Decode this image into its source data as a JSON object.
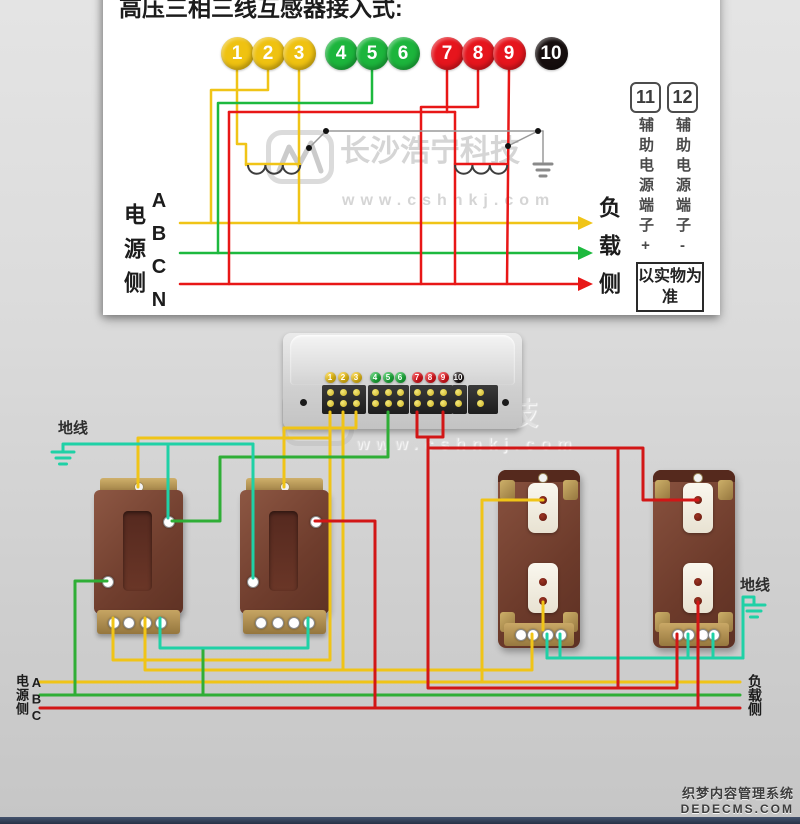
{
  "title": "高压三相三线互感器接入式:",
  "watermark": {
    "name": "长沙浩宁科技",
    "url": "www.cshnkj.com"
  },
  "cms_watermark": {
    "line1": "织梦内容管理系统",
    "line2": "DEDECMS.COM"
  },
  "top_panel": {
    "source_side": "电源侧",
    "phases": "ABCN",
    "load_side": "负载侧",
    "note": "以实物为准",
    "aux": [
      {
        "id": "11",
        "label": "辅助电源端子+"
      },
      {
        "id": "12",
        "label": "辅助电源端子-"
      }
    ],
    "terminals": [
      {
        "n": "1",
        "color": "#efc211",
        "x": 237
      },
      {
        "n": "2",
        "color": "#efc211",
        "x": 268
      },
      {
        "n": "3",
        "color": "#efc211",
        "x": 299
      },
      {
        "n": "4",
        "color": "#1cb53c",
        "x": 341
      },
      {
        "n": "5",
        "color": "#1cb53c",
        "x": 372
      },
      {
        "n": "6",
        "color": "#1cb53c",
        "x": 403
      },
      {
        "n": "7",
        "color": "#e6151d",
        "x": 447
      },
      {
        "n": "8",
        "color": "#e6151d",
        "x": 478
      },
      {
        "n": "9",
        "color": "#e6151d",
        "x": 509
      },
      {
        "n": "10",
        "color": "#160e0e",
        "x": 551
      }
    ]
  },
  "meter": {
    "terminals": [
      {
        "n": "1",
        "color": "#efc211",
        "x": 330
      },
      {
        "n": "2",
        "color": "#efc211",
        "x": 343
      },
      {
        "n": "3",
        "color": "#efc211",
        "x": 356
      },
      {
        "n": "4",
        "color": "#1cb53c",
        "x": 375
      },
      {
        "n": "5",
        "color": "#1cb53c",
        "x": 388
      },
      {
        "n": "6",
        "color": "#1cb53c",
        "x": 400
      },
      {
        "n": "7",
        "color": "#e6151d",
        "x": 417
      },
      {
        "n": "8",
        "color": "#e6151d",
        "x": 430
      },
      {
        "n": "9",
        "color": "#e6151d",
        "x": 443
      },
      {
        "n": "10",
        "color": "#160e0e",
        "x": 458
      }
    ],
    "screw_columns": [
      330,
      343,
      356,
      375,
      388,
      400,
      417,
      430,
      443,
      458,
      480
    ]
  },
  "bottom": {
    "ground_left": "地线",
    "ground_right": "地线",
    "source_side": "电源侧",
    "source_phases": "ABC",
    "load_side": "负载侧"
  },
  "wiring": {
    "wires": [
      {
        "c": "#f0c417",
        "w": 2.5,
        "p": [
          [
            180,
            223
          ],
          [
            578,
            223
          ]
        ]
      },
      {
        "c": "#f0c417",
        "w": 2.5,
        "p": [
          [
            268,
            70
          ],
          [
            268,
            90
          ],
          [
            211,
            90
          ],
          [
            211,
            223
          ]
        ]
      },
      {
        "c": "#f0c417",
        "w": 2.5,
        "p": [
          [
            237,
            70
          ],
          [
            237,
            144
          ],
          [
            246,
            144
          ],
          [
            246,
            165
          ]
        ]
      },
      {
        "c": "#f0c417",
        "w": 2.5,
        "p": [
          [
            299,
            70
          ],
          [
            299,
            223
          ]
        ]
      },
      {
        "c": "#f0c417",
        "w": 2.5,
        "p": [
          [
            246,
            164
          ],
          [
            300,
            164
          ]
        ]
      },
      {
        "c": "#1db93e",
        "w": 2.5,
        "p": [
          [
            180,
            253
          ],
          [
            578,
            253
          ]
        ]
      },
      {
        "c": "#1db93e",
        "w": 2.5,
        "p": [
          [
            372,
            70
          ],
          [
            372,
            103
          ],
          [
            218,
            103
          ],
          [
            218,
            253
          ]
        ]
      },
      {
        "c": "#e81717",
        "w": 2.5,
        "p": [
          [
            180,
            284
          ],
          [
            578,
            284
          ]
        ]
      },
      {
        "c": "#e81717",
        "w": 2.5,
        "p": [
          [
            447,
            70
          ],
          [
            447,
            112
          ]
        ]
      },
      {
        "c": "#e81717",
        "w": 2.5,
        "p": [
          [
            229,
            112
          ],
          [
            455,
            112
          ]
        ]
      },
      {
        "c": "#e81717",
        "w": 2.5,
        "p": [
          [
            229,
            112
          ],
          [
            229,
            284
          ]
        ]
      },
      {
        "c": "#e81717",
        "w": 2.5,
        "p": [
          [
            455,
            112
          ],
          [
            455,
            284
          ]
        ]
      },
      {
        "c": "#e81717",
        "w": 2.5,
        "p": [
          [
            509,
            70
          ],
          [
            507,
            284
          ]
        ]
      },
      {
        "c": "#e81717",
        "w": 2.5,
        "p": [
          [
            478,
            70
          ],
          [
            478,
            107
          ],
          [
            421,
            107
          ],
          [
            421,
            284
          ]
        ]
      },
      {
        "c": "#e81717",
        "w": 2.5,
        "p": [
          [
            455,
            164
          ],
          [
            507,
            164
          ]
        ]
      },
      {
        "c": "#9a9a9a",
        "w": 1.5,
        "p": [
          [
            309,
            148
          ],
          [
            326,
            131
          ]
        ]
      },
      {
        "c": "#9a9a9a",
        "w": 1.5,
        "p": [
          [
            326,
            131
          ],
          [
            543,
            131
          ]
        ]
      },
      {
        "c": "#9a9a9a",
        "w": 1.5,
        "p": [
          [
            508,
            146
          ],
          [
            538,
            131
          ]
        ]
      },
      {
        "c": "#9a9a9a",
        "w": 1.5,
        "p": [
          [
            543,
            131
          ],
          [
            543,
            162
          ]
        ]
      },
      {
        "c": "#f0c417",
        "w": 3,
        "p": [
          [
            330,
            412
          ],
          [
            330,
            660
          ],
          [
            113,
            660
          ],
          [
            113,
            618
          ]
        ]
      },
      {
        "c": "#f0c417",
        "w": 3,
        "p": [
          [
            343,
            412
          ],
          [
            343,
            670
          ]
        ]
      },
      {
        "c": "#f0c417",
        "w": 3,
        "p": [
          [
            145,
            618
          ],
          [
            145,
            670
          ],
          [
            532,
            670
          ],
          [
            532,
            634
          ]
        ]
      },
      {
        "c": "#f0c417",
        "w": 3,
        "p": [
          [
            543,
            500
          ],
          [
            482,
            500
          ],
          [
            482,
            682
          ]
        ]
      },
      {
        "c": "#f0c417",
        "w": 3,
        "p": [
          [
            543,
            602
          ],
          [
            543,
            630
          ]
        ]
      },
      {
        "c": "#f0c417",
        "w": 3,
        "p": [
          [
            40,
            682
          ],
          [
            740,
            682
          ]
        ]
      },
      {
        "c": "#f0c417",
        "w": 3,
        "p": [
          [
            138,
            487
          ],
          [
            138,
            438
          ],
          [
            330,
            438
          ]
        ]
      },
      {
        "c": "#f0c417",
        "w": 3,
        "p": [
          [
            284,
            487
          ],
          [
            284,
            428
          ],
          [
            356,
            428
          ],
          [
            356,
            412
          ]
        ]
      },
      {
        "c": "#2fae36",
        "w": 3,
        "p": [
          [
            388,
            412
          ],
          [
            388,
            457
          ],
          [
            220,
            457
          ],
          [
            220,
            521
          ],
          [
            172,
            521
          ]
        ]
      },
      {
        "c": "#2fae36",
        "w": 3,
        "p": [
          [
            107,
            581
          ],
          [
            75,
            581
          ],
          [
            75,
            695
          ]
        ]
      },
      {
        "c": "#2fae36",
        "w": 3,
        "p": [
          [
            203,
            648
          ],
          [
            203,
            695
          ]
        ]
      },
      {
        "c": "#2fae36",
        "w": 3,
        "p": [
          [
            40,
            695
          ],
          [
            740,
            695
          ]
        ]
      },
      {
        "c": "#1fd1a6",
        "w": 3,
        "p": [
          [
            63,
            444
          ],
          [
            253,
            444
          ]
        ]
      },
      {
        "c": "#1fd1a6",
        "w": 3,
        "p": [
          [
            168,
            444
          ],
          [
            168,
            518
          ]
        ]
      },
      {
        "c": "#1fd1a6",
        "w": 3,
        "p": [
          [
            253,
            444
          ],
          [
            253,
            578
          ]
        ]
      },
      {
        "c": "#1fd1a6",
        "w": 3,
        "p": [
          [
            160,
            618
          ],
          [
            160,
            648
          ],
          [
            308,
            648
          ],
          [
            308,
            618
          ]
        ]
      },
      {
        "c": "#1fd1a6",
        "w": 3,
        "p": [
          [
            547,
            634
          ],
          [
            547,
            658
          ]
        ]
      },
      {
        "c": "#1fd1a6",
        "w": 3,
        "p": [
          [
            560,
            634
          ],
          [
            560,
            658
          ]
        ]
      },
      {
        "c": "#1fd1a6",
        "w": 3,
        "p": [
          [
            547,
            658
          ],
          [
            743,
            658
          ]
        ]
      },
      {
        "c": "#1fd1a6",
        "w": 3,
        "p": [
          [
            688,
            634
          ],
          [
            688,
            658
          ]
        ]
      },
      {
        "c": "#1fd1a6",
        "w": 3,
        "p": [
          [
            713,
            634
          ],
          [
            713,
            658
          ]
        ]
      },
      {
        "c": "#1fd1a6",
        "w": 3,
        "p": [
          [
            743,
            658
          ],
          [
            743,
            597
          ],
          [
            754,
            597
          ]
        ]
      },
      {
        "c": "#d21616",
        "w": 3,
        "p": [
          [
            417,
            412
          ],
          [
            417,
            437
          ],
          [
            443,
            437
          ],
          [
            443,
            412
          ]
        ]
      },
      {
        "c": "#d21616",
        "w": 3,
        "p": [
          [
            428,
            437
          ],
          [
            428,
            688
          ],
          [
            677,
            688
          ],
          [
            677,
            634
          ]
        ]
      },
      {
        "c": "#d21616",
        "w": 3,
        "p": [
          [
            428,
            448
          ],
          [
            643,
            448
          ],
          [
            643,
            500
          ],
          [
            698,
            500
          ]
        ]
      },
      {
        "c": "#d21616",
        "w": 3,
        "p": [
          [
            315,
            521
          ],
          [
            375,
            521
          ],
          [
            375,
            708
          ]
        ]
      },
      {
        "c": "#d21616",
        "w": 3,
        "p": [
          [
            618,
            448
          ],
          [
            618,
            688
          ]
        ]
      },
      {
        "c": "#d21616",
        "w": 3,
        "p": [
          [
            698,
            602
          ],
          [
            698,
            708
          ]
        ]
      },
      {
        "c": "#d21616",
        "w": 3,
        "p": [
          [
            40,
            708
          ],
          [
            740,
            708
          ]
        ]
      }
    ],
    "coils": [
      {
        "x": 248,
        "y": 165,
        "n": 3,
        "r": 8.7,
        "c": "#3d3d3d"
      },
      {
        "x": 455,
        "y": 165,
        "n": 3,
        "r": 8.7,
        "c": "#3d3d3d"
      }
    ],
    "dots": [
      {
        "x": 309,
        "y": 148
      },
      {
        "x": 326,
        "y": 131
      },
      {
        "x": 508,
        "y": 146
      },
      {
        "x": 538,
        "y": 131
      }
    ],
    "arrows": [
      {
        "x": 578,
        "y": 223,
        "c": "#f0c417"
      },
      {
        "x": 578,
        "y": 253,
        "c": "#1db93e"
      },
      {
        "x": 578,
        "y": 284,
        "c": "#e81717"
      }
    ],
    "grounds": [
      {
        "x": 63,
        "y": 452,
        "c": "#1fd1a6",
        "widths": [
          22,
          14,
          7
        ],
        "stub": 8
      },
      {
        "x": 754,
        "y": 605,
        "c": "#1fd1a6",
        "widths": [
          22,
          14,
          7
        ],
        "stub": 8
      },
      {
        "x": 543,
        "y": 164,
        "c": "#8a8a8a",
        "widths": [
          18,
          12,
          6
        ],
        "stub": 0
      }
    ]
  }
}
